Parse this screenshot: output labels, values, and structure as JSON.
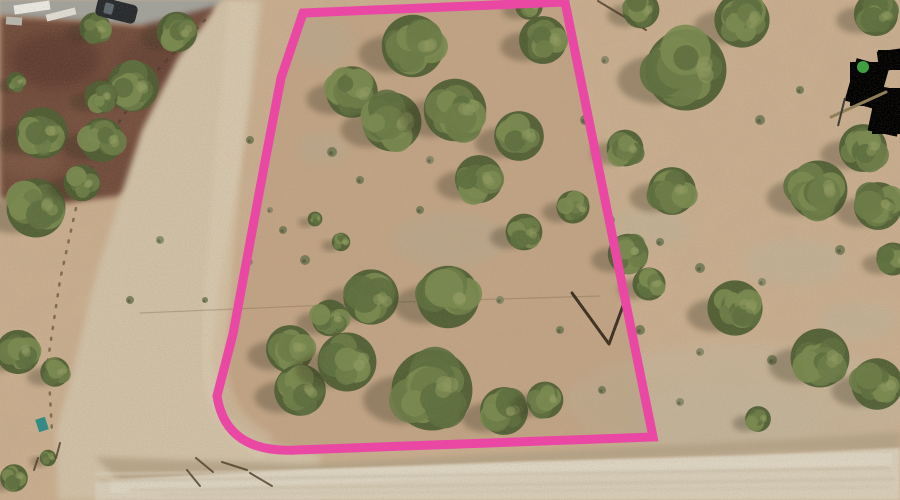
{
  "image": {
    "width": 900,
    "height": 500,
    "alt": "Aerial drone photo of a vacant juniper-dotted desert land parcel outlined with a pink boundary, bordered by dirt roads, a cinder parking lot at top left and a small cabin at right edge"
  },
  "palette": {
    "ground": "#c9ae8f",
    "road": "#cfc0a6",
    "road_stripe": "#d9cbb1",
    "bottom_road": "#d6ccb8",
    "bottom_road_stripe": "#ded6c4",
    "gravel": "#b2a185",
    "parking": "#6d4739",
    "pavement": "#a2a29b",
    "boundary_pink": "#ee44a6",
    "tree_base": "#4e5e33",
    "tree_clumps": [
      "#5d6f3e",
      "#6b7c47",
      "#79894f"
    ],
    "tree_highlight": "#8d9a5e",
    "tree_shadow": "#332e1e",
    "shrub": "#6b7450",
    "shrub_alt": "#7e8263"
  },
  "terrain": {
    "base": "#c9ae8f",
    "mottle_opacity": 0.3,
    "grain_opacity": 0.45,
    "light_color": "#bab29b",
    "light_opacity": 0.45,
    "light_patches": [
      [
        325,
        42,
        30,
        26
      ],
      [
        323,
        149,
        26,
        17
      ],
      [
        648,
        228,
        42,
        18
      ],
      [
        795,
        262,
        52,
        22
      ],
      [
        725,
        420,
        95,
        38
      ],
      [
        858,
        322,
        40,
        18
      ],
      [
        450,
        240,
        60,
        28
      ]
    ],
    "rocky_patch": [
      740,
      402,
      175,
      58
    ],
    "rocky_color": "#c2b59d",
    "rocky_opacity": 0.5
  },
  "pavement": {
    "points": "0,0 225,0 204,16 150,26 0,15",
    "color": "#a2a29b"
  },
  "parking_lot": {
    "points": "0,16 96,22 140,26 216,6 198,88 176,170 118,196 58,204 0,198",
    "color": "#6d4739",
    "patches": [
      [
        55,
        60,
        45,
        28,
        "#5c392f",
        0.7
      ],
      [
        105,
        120,
        42,
        26,
        "#7a5243",
        0.55
      ],
      [
        152,
        62,
        35,
        22,
        "#613d31",
        0.5
      ],
      [
        30,
        160,
        30,
        18,
        "#8a6350",
        0.4
      ]
    ]
  },
  "roads": {
    "main": {
      "points": "222,0 262,0 252,90 240,170 220,280 212,360 224,410 262,440 320,456 320,500 58,500 56,432 74,368 92,290 118,205 142,130 178,58",
      "color": "#cfc0a6",
      "stripe": "M242,2 C232,110 222,230 214,330 C210,390 225,425 268,447",
      "stripe_color": "#d9cbb1"
    },
    "bottom": {
      "points": "95,482 300,470 520,462 740,456 900,448 900,500 95,500",
      "color": "#d6ccb8",
      "stripe": "M110,487 C350,473 650,465 892,459",
      "stripe_color": "#ded6c4"
    },
    "gravel_band": {
      "points": "95,457 300,464 560,450 780,440 900,432 900,450 780,452 560,462 300,476 120,482",
      "color": "#b2a185",
      "opacity": 0.85
    },
    "tire_streaks": [
      [
        100,
        481,
        890,
        468,
        "#c3b69e",
        2
      ],
      [
        130,
        490,
        895,
        479,
        "#c9bda6",
        2.5
      ],
      [
        95,
        474,
        880,
        462,
        "#e0d8c6",
        2
      ],
      [
        160,
        495,
        890,
        487,
        "#cdc2ac",
        2
      ]
    ]
  },
  "fences": [
    {
      "name": "west-fence-line",
      "points": "205,20 148,80 103,145 80,190 60,280 48,360 52,432",
      "color": "#42351f",
      "width": 2.5,
      "dash": "2 9",
      "opacity": 0.55
    },
    {
      "name": "north-fence-rail",
      "points": "598,1 646,30",
      "color": "#4a3a25",
      "width": 2,
      "dash": "",
      "opacity": 0.8
    },
    {
      "name": "powerline-shadow",
      "points": "140,313 400,302 600,296",
      "color": "#554733",
      "width": 1.2,
      "dash": "",
      "opacity": 0.25
    }
  ],
  "parcel": {
    "path": "M303,13 L565,2 L653,437 L297,450 Q226,454 217,396 L233,334 L264,167 L281,78 Z",
    "boundary_color": "#ee44a6",
    "stroke_width": 9,
    "interior_tint": "rgba(150,108,72,0.14)"
  },
  "survey_v_mark": {
    "points": "572,293 609,344 624,303",
    "color": "#241c10",
    "width": 3
  },
  "gate_marks": [
    [
      196,
      458,
      213,
      472
    ],
    [
      222,
      462,
      247,
      470
    ],
    [
      250,
      473,
      272,
      486
    ],
    [
      187,
      470,
      200,
      486
    ],
    [
      60,
      443,
      56,
      458
    ],
    [
      38,
      458,
      34,
      470
    ]
  ],
  "trees": [
    [
      95,
      28,
      17
    ],
    [
      177,
      32,
      22
    ],
    [
      133,
      86,
      28
    ],
    [
      101,
      97,
      18
    ],
    [
      16,
      82,
      11
    ],
    [
      42,
      133,
      28
    ],
    [
      102,
      140,
      24
    ],
    [
      36,
      208,
      32
    ],
    [
      82,
      183,
      20
    ],
    [
      18,
      352,
      24
    ],
    [
      55,
      372,
      16
    ],
    [
      14,
      478,
      15
    ],
    [
      48,
      458,
      9
    ],
    [
      413,
      46,
      34
    ],
    [
      352,
      92,
      28
    ],
    [
      392,
      122,
      32
    ],
    [
      455,
      110,
      34
    ],
    [
      519,
      136,
      27
    ],
    [
      543,
      40,
      26
    ],
    [
      529,
      6,
      15
    ],
    [
      479,
      179,
      26
    ],
    [
      573,
      207,
      18
    ],
    [
      524,
      232,
      20
    ],
    [
      315,
      219,
      8
    ],
    [
      341,
      242,
      10
    ],
    [
      371,
      297,
      30
    ],
    [
      448,
      297,
      34
    ],
    [
      330,
      318,
      20
    ],
    [
      290,
      349,
      26
    ],
    [
      300,
      390,
      28
    ],
    [
      347,
      362,
      32
    ],
    [
      432,
      390,
      44
    ],
    [
      504,
      411,
      26
    ],
    [
      545,
      400,
      20
    ],
    [
      641,
      10,
      20
    ],
    [
      742,
      20,
      30
    ],
    [
      876,
      14,
      24
    ],
    [
      686,
      70,
      44
    ],
    [
      863,
      148,
      26
    ],
    [
      625,
      148,
      20
    ],
    [
      672,
      191,
      26
    ],
    [
      818,
      190,
      32
    ],
    [
      878,
      206,
      26
    ],
    [
      893,
      259,
      18
    ],
    [
      628,
      254,
      22
    ],
    [
      649,
      284,
      18
    ],
    [
      735,
      308,
      30
    ],
    [
      820,
      358,
      32
    ],
    [
      877,
      384,
      28
    ],
    [
      758,
      419,
      14
    ]
  ],
  "shrubs": [
    [
      610,
      220,
      5
    ],
    [
      660,
      242,
      4
    ],
    [
      700,
      268,
      5
    ],
    [
      762,
      282,
      4
    ],
    [
      840,
      250,
      5
    ],
    [
      640,
      330,
      5
    ],
    [
      700,
      352,
      4
    ],
    [
      772,
      360,
      5
    ],
    [
      602,
      390,
      4
    ],
    [
      680,
      402,
      4
    ],
    [
      305,
      260,
      5
    ],
    [
      420,
      210,
      4
    ],
    [
      500,
      300,
      4
    ],
    [
      560,
      330,
      4
    ],
    [
      360,
      180,
      4
    ],
    [
      430,
      160,
      4
    ],
    [
      332,
      152,
      5
    ],
    [
      283,
      230,
      4
    ],
    [
      250,
      262,
      3
    ],
    [
      205,
      300,
      3
    ],
    [
      585,
      120,
      5
    ],
    [
      605,
      60,
      4
    ],
    [
      760,
      120,
      5
    ],
    [
      800,
      90,
      4
    ],
    [
      160,
      240,
      4
    ],
    [
      130,
      300,
      4
    ],
    [
      250,
      140,
      4
    ],
    [
      270,
      210,
      3
    ]
  ],
  "structures": {
    "car": {
      "x": 96,
      "y": 1,
      "w": 41,
      "h": 19,
      "angle": 14,
      "body": "#26292d",
      "glass": "#5d686e"
    },
    "white_slabs": [
      [
        14,
        3,
        36,
        9,
        -8,
        "#e9e7e0"
      ],
      [
        46,
        11,
        30,
        7,
        -14,
        "#dfdcd3"
      ],
      [
        6,
        17,
        16,
        8,
        4,
        "#b8b6ad"
      ]
    ],
    "cabin": {
      "pad": [
        878,
        50,
        24,
        20,
        -8,
        "#c9c6bd"
      ],
      "shed": [
        850,
        62,
        34,
        44,
        16,
        "#2c2e31"
      ],
      "deck": [
        872,
        88,
        30,
        46,
        12,
        "#3a6055"
      ],
      "green_item": [
        863,
        67,
        6,
        "#3ba03e"
      ],
      "pole": [
        831,
        117,
        886,
        92,
        "#8f7f57",
        3
      ],
      "post": [
        845,
        98,
        838,
        126,
        "#3a3a38",
        2
      ]
    },
    "teal_bin": [
      37,
      418,
      10,
      13,
      -18,
      "#2f8b86"
    ]
  }
}
